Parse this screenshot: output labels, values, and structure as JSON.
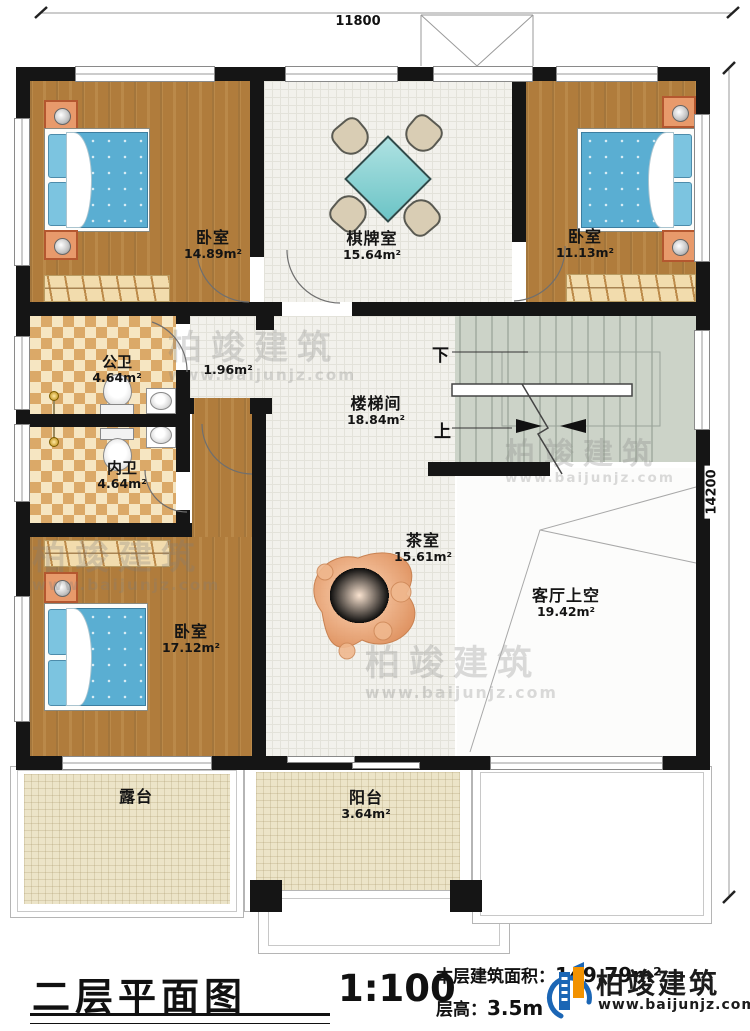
{
  "dimensions": {
    "top_width": "11800",
    "right_height": "14200"
  },
  "rooms": {
    "bedroom_top_left": {
      "label": "卧室",
      "area": "14.89m²"
    },
    "game_room": {
      "label": "棋牌室",
      "area": "15.64m²"
    },
    "bedroom_top_right": {
      "label": "卧室",
      "area": "11.13m²"
    },
    "public_bathroom": {
      "label": "公卫",
      "area": "4.64m²"
    },
    "vestibule": {
      "area": "1.96m²"
    },
    "private_bathroom": {
      "label": "内卫",
      "area": "4.64m²"
    },
    "stairwell": {
      "label": "楼梯间",
      "area": "18.84m²",
      "down": "下",
      "up": "上"
    },
    "tea_room": {
      "label": "茶室",
      "area": "15.61m²"
    },
    "living_room_void": {
      "label": "客厅上空",
      "area": "19.42m²"
    },
    "bedroom_bottom_left": {
      "label": "卧室",
      "area": "17.12m²"
    },
    "terrace": {
      "label": "露台"
    },
    "balcony": {
      "label": "阳台",
      "area": "3.64m²"
    }
  },
  "watermark": {
    "brand": "柏竣建筑",
    "url": "www.baijunjz.com"
  },
  "title_block": {
    "plan_title": "二层平面图",
    "scale": "1:100",
    "area_label": "本层建筑面积：",
    "area_value": "149.79m²",
    "height_label": "层高：",
    "height_value": "3.5m"
  },
  "logo": {
    "brand": "柏竣建筑",
    "url": "www.baijunjz.com"
  },
  "colors": {
    "wall": "#151515",
    "wood_floor": "#b07c3c",
    "tile": "#f2f1ec",
    "checker_dark": "#dba968",
    "checker_light": "#f6e6c2",
    "stair": "#ccd3c8",
    "outdoor_tile": "#ece4c8",
    "mattress": "#5aaed2",
    "table": "#7fcfcf",
    "logo_blue": "#1b66b5",
    "logo_orange": "#f29200"
  }
}
